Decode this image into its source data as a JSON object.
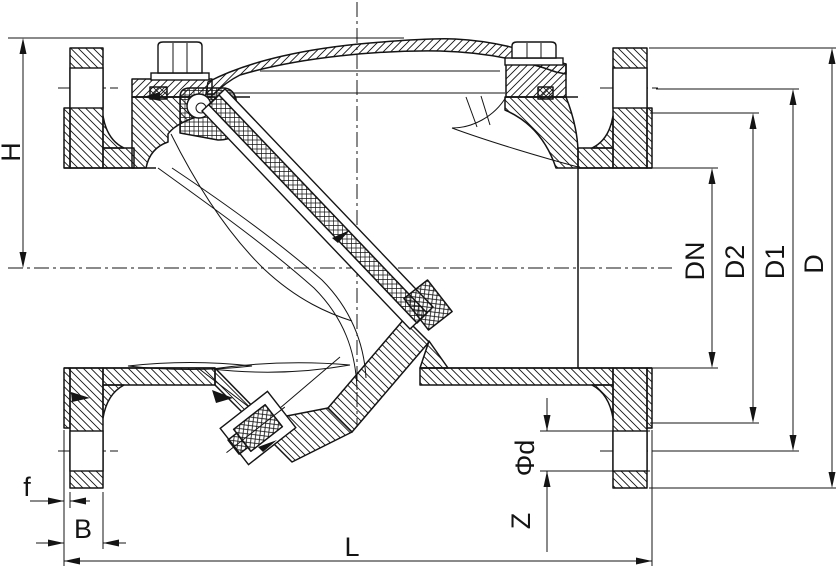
{
  "drawing": {
    "kind": "sectional technical drawing of a flanged swing check valve",
    "colors": {
      "line": "#141414",
      "background": "#ffffff"
    },
    "dimensions": {
      "H": "H",
      "f": "f",
      "B": "B",
      "L": "L",
      "Z": "Z",
      "Phi_d": "Φd",
      "DN": "DN",
      "D2": "D2",
      "D1": "D1",
      "D": "D"
    }
  }
}
